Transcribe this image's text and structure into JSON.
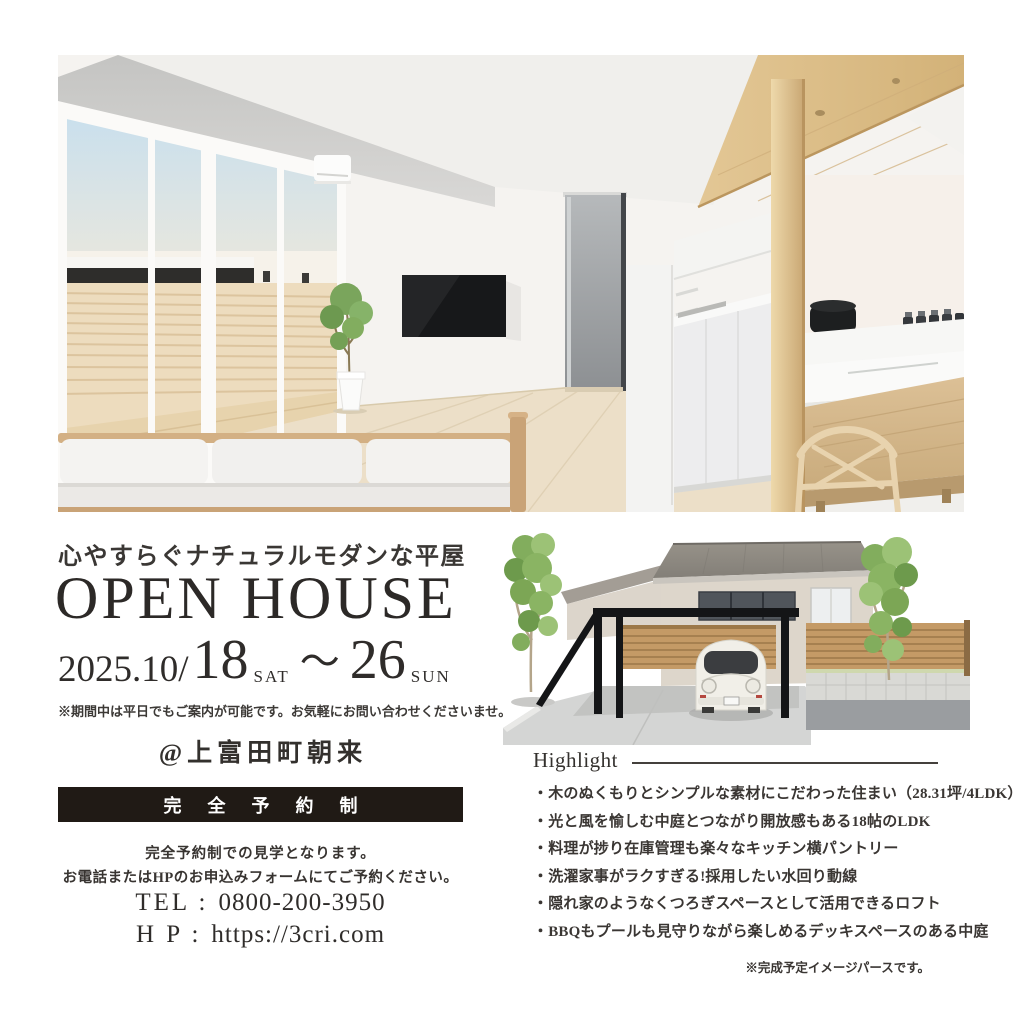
{
  "palette": {
    "ink": "#363230",
    "banner_bg": "#201a15",
    "wood_accent": "#dcbf8e",
    "sky": "#c3def0",
    "carport_black": "#141517"
  },
  "left_column": {
    "tagline": "心やすらぐナチュラルモダンな平屋",
    "title": "OPEN HOUSE",
    "schedule": {
      "year_month": "2025.10/",
      "start_day": "18",
      "start_dow": "SAT",
      "range_mark": "〜",
      "end_day": "26",
      "end_dow": "SUN"
    },
    "schedule_note": "※期間中は平日でもご案内が可能です。お気軽にお問い合わせくださいませ。",
    "venue": "@上富田町朝来",
    "reservation_banner": "完全予約制",
    "reservation_note_line1": "完全予約制での見学となります。",
    "reservation_note_line2": "お電話またはHPのお申込みフォームにてご予約ください。",
    "tel_label": "TEL :",
    "tel_number": "0800-200-3950",
    "hp_label": "H P :",
    "hp_url": "https://3cri.com"
  },
  "right_column": {
    "highlight_title": "Highlight",
    "highlights": [
      "・木のぬくもりとシンプルな素材にこだわった住まい（28.31坪/4LDK）",
      "・光と風を愉しむ中庭とつながり開放感もある18帖のLDK",
      "・料理が捗り在庫管理も楽々なキッチン横パントリー",
      "・洗濯家事がラクすぎる!採用したい水回り動線",
      "・隠れ家のようなくつろぎスペースとして活用できるロフト",
      "・BBQもプールも見守りながら楽しめるデッキスペースのある中庭"
    ],
    "disclaimer": "※完成予定イメージパースです。"
  }
}
